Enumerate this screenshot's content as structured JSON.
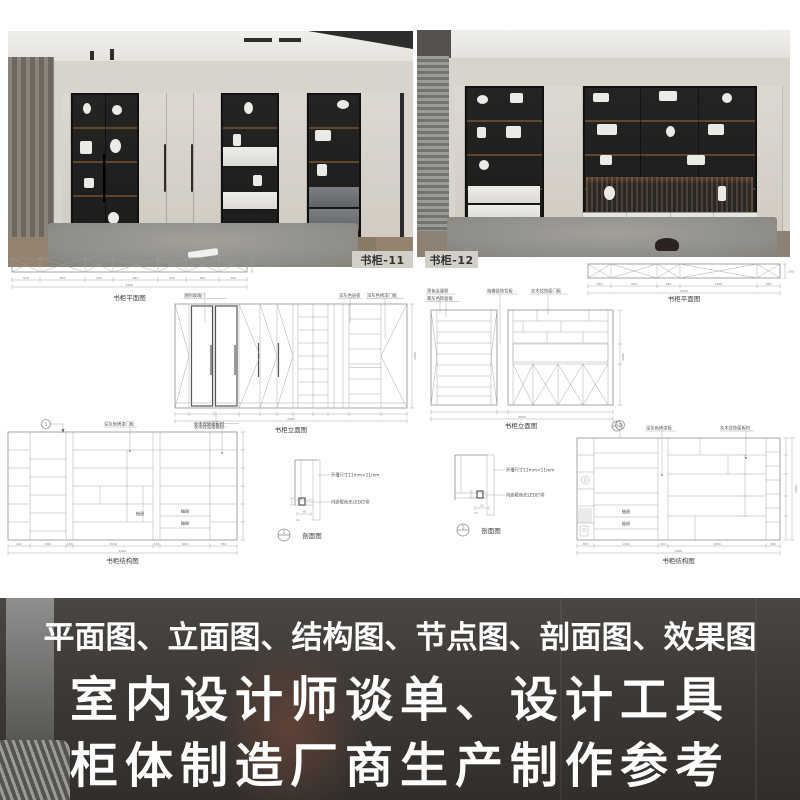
{
  "photos": {
    "left": {
      "label": "书柜-11"
    },
    "right": {
      "label": "书柜-12"
    }
  },
  "drawings": {
    "section_no": "1",
    "plan_left": {
      "title": "书柜平面图",
      "dims": [
        "520",
        "840",
        "520",
        "840",
        "520",
        "620",
        "540"
      ],
      "total": "4400",
      "depth": "280"
    },
    "plan_right": {
      "title": "书柜平面图",
      "dims": [
        "480",
        "960",
        "480",
        "1600",
        "480"
      ],
      "total": "4000",
      "depth": "280"
    },
    "elev_left": {
      "title": "书柜立面图",
      "total": "4400",
      "height": "2680",
      "callouts": [
        "透明玻璃门",
        "深灰色层板",
        "深灰色烤漆门板"
      ],
      "note": "灰木纹免漆板材"
    },
    "elev_right": {
      "title": "书柜立面图",
      "total": "4000",
      "height": "2680",
      "callouts": [
        "黑色金属框",
        "暖灰色饰面板",
        "格栅装饰背板",
        "灰木纹饰面门板"
      ]
    },
    "struct_left": {
      "title": "书柜结构图",
      "dims": [
        "420",
        "690",
        "130",
        "1540",
        "130",
        "960",
        "530"
      ],
      "total": "4400",
      "callouts": [
        "深灰色烤漆门板",
        "灰木纹饰面板材"
      ],
      "drawer": "抽屉"
    },
    "struct_right": {
      "title": "书柜结构图",
      "dims": [
        "330",
        "1260",
        "200",
        "1930",
        "280"
      ],
      "total": "4000",
      "height": "2680",
      "callouts": [
        "深灰色烤漆板",
        "灰木纹饰面板材"
      ],
      "drawer": "抽屉"
    },
    "detail": {
      "title": "剖面图",
      "callout_groove": "开槽尺寸11mm×11mm",
      "callout_led": "内嵌暖色光LED灯带",
      "dim_w": "30",
      "dim_h": "11"
    }
  },
  "banner": {
    "line1": "平面图、立面图、结构图、节点图、剖面图、效果图",
    "line2": "室内设计师谈单、设计工具",
    "line3": "柜体制造厂商生产制作参考"
  }
}
